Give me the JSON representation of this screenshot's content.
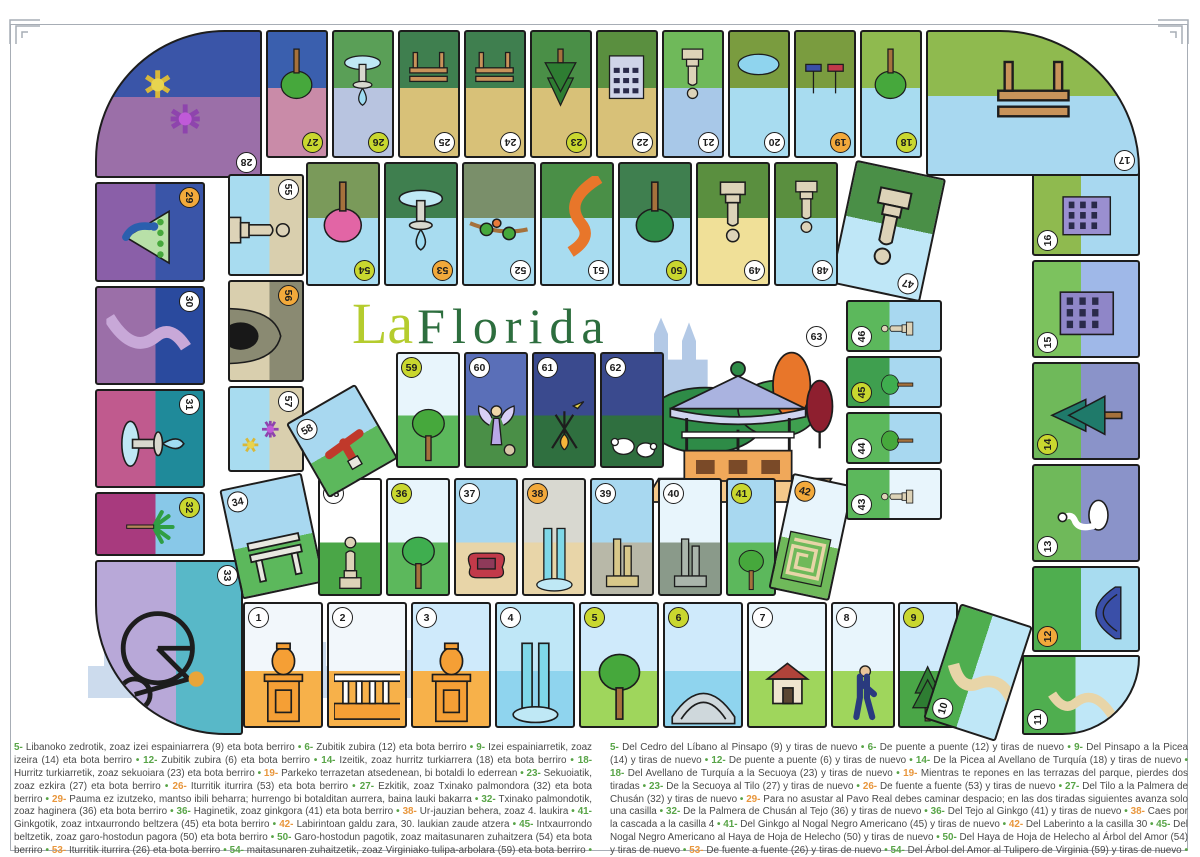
{
  "poster": {
    "title_la": "La",
    "title_florida": "Florida",
    "title_la_color": "#b5cc2e",
    "title_florida_color": "#2d6e3e"
  },
  "board": {
    "badge_colors": {
      "normal": "#ffffff",
      "jump": "#c9d72f",
      "event": "#f2a93b",
      "final": "#ffffff"
    },
    "final_badge": "63",
    "cells": [
      {
        "n": 1,
        "name": "pilar-entrada",
        "kind": "normal",
        "motif": "urn",
        "sky": "#f2f7fb",
        "ground": "#f7b14a"
      },
      {
        "n": 2,
        "name": "barandilla",
        "kind": "normal",
        "motif": "railing",
        "sky": "#f2f7fb",
        "ground": "#f7b14a"
      },
      {
        "n": 3,
        "name": "pilar",
        "kind": "normal",
        "motif": "urn",
        "sky": "#cfeafb",
        "ground": "#f7b14a"
      },
      {
        "n": 4,
        "name": "estanque-cascada",
        "kind": "normal",
        "motif": "waterfall",
        "sky": "#bfe7f7",
        "ground": "#8fd4ee"
      },
      {
        "n": 5,
        "name": "cedro-del-libano",
        "kind": "jump",
        "motif": "tree",
        "c": "#46a83c",
        "sky": "#cfeafb",
        "ground": "#9fd65c"
      },
      {
        "n": 6,
        "name": "puente",
        "kind": "jump",
        "motif": "bridge",
        "sky": "#cfeafb",
        "ground": "#8fd4ee"
      },
      {
        "n": 7,
        "name": "caseta",
        "kind": "normal",
        "motif": "hut",
        "sky": "#e8f5fc",
        "ground": "#9fd65c"
      },
      {
        "n": 8,
        "name": "paseante",
        "kind": "normal",
        "motif": "person",
        "sky": "#e8f5fc",
        "ground": "#9fd65c"
      },
      {
        "n": 9,
        "name": "pinsapo",
        "kind": "jump",
        "motif": "pine",
        "c": "#2e7d32",
        "sky": "#cfeafb",
        "ground": "#4aa647"
      },
      {
        "n": 10,
        "name": "senda-rio",
        "kind": "normal",
        "motif": "path",
        "sky": "#bfe7f7",
        "ground": "#4fae4f"
      },
      {
        "n": 11,
        "name": "senda-rio",
        "kind": "normal",
        "motif": "path",
        "sky": "#bfe7f7",
        "ground": "#4fae4f"
      },
      {
        "n": 12,
        "name": "puente-azul",
        "kind": "event",
        "motif": "bridge",
        "c": "#3a4fa8",
        "sky": "#a8dcf0",
        "ground": "#4fae4f"
      },
      {
        "n": 13,
        "name": "cisne",
        "kind": "normal",
        "motif": "swan",
        "sky": "#8a93c9",
        "ground": "#6fb95a"
      },
      {
        "n": 14,
        "name": "picea",
        "kind": "jump",
        "motif": "pine",
        "c": "#1f7a6a",
        "sky": "#8a93c9",
        "ground": "#6fb95a"
      },
      {
        "n": 15,
        "name": "edificio-flores",
        "kind": "normal",
        "motif": "building",
        "c": "#8f86c8",
        "sky": "#9fb8e8",
        "ground": "#7cc25e"
      },
      {
        "n": 16,
        "name": "edificio",
        "kind": "normal",
        "motif": "building",
        "c": "#9a8fd0",
        "sky": "#a8d8f0",
        "ground": "#8fba4f"
      },
      {
        "n": 17,
        "name": "merendero",
        "kind": "normal",
        "motif": "bench",
        "sky": "#a8d8f0",
        "ground": "#8fba4f"
      },
      {
        "n": 18,
        "name": "avellano-de-turquia",
        "kind": "jump",
        "motif": "tree",
        "c": "#46a83c",
        "sky": "#a8dcf0",
        "ground": "#8fba4f"
      },
      {
        "n": 19,
        "name": "terrazas-embarcadero",
        "kind": "event",
        "motif": "boats",
        "sky": "#a8dcf0",
        "ground": "#7a9c3f"
      },
      {
        "n": 20,
        "name": "estanque",
        "kind": "normal",
        "motif": "pond",
        "sky": "#a8dcf0",
        "ground": "#7a9c3f"
      },
      {
        "n": 21,
        "name": "estatua",
        "kind": "normal",
        "motif": "statue",
        "sky": "#a8c8e8",
        "ground": "#6fb95a"
      },
      {
        "n": 22,
        "name": "palacete",
        "kind": "normal",
        "motif": "building",
        "c": "#cfd4e8",
        "sky": "#d8c178",
        "ground": "#5a8f3f"
      },
      {
        "n": 23,
        "name": "secuoya",
        "kind": "jump",
        "motif": "pine",
        "c": "#2e7d32",
        "sky": "#d8c178",
        "ground": "#4a8f47"
      },
      {
        "n": 24,
        "name": "banco",
        "kind": "normal",
        "motif": "bench",
        "sky": "#d8c178",
        "ground": "#3f7f4f"
      },
      {
        "n": 25,
        "name": "banco",
        "kind": "normal",
        "motif": "bench",
        "sky": "#d8c178",
        "ground": "#3f7f4f"
      },
      {
        "n": 26,
        "name": "fuente",
        "kind": "jump",
        "motif": "fountain",
        "sky": "#b8c4e0",
        "ground": "#5a9f57"
      },
      {
        "n": 27,
        "name": "tilo",
        "kind": "jump",
        "motif": "tree",
        "c": "#46a83c",
        "sky": "#c98ba8",
        "ground": "#3a5fae"
      },
      {
        "n": 28,
        "name": "parterres",
        "kind": "normal",
        "motif": "flowers",
        "sky": "#9b6fa8",
        "ground": "#3a55a8"
      },
      {
        "n": 29,
        "name": "pavo-real",
        "kind": "event",
        "motif": "peacock",
        "sky": "#8a5fa8",
        "ground": "#3a55a8"
      },
      {
        "n": 30,
        "name": "paseo-nocturno",
        "kind": "normal",
        "motif": "path",
        "c": "#c8a8d8",
        "sky": "#9b6fa8",
        "ground": "#2a4a9e"
      },
      {
        "n": 31,
        "name": "fuente-nocturna",
        "kind": "normal",
        "motif": "fountain",
        "sky": "#c05a8e",
        "ground": "#1f8a9a"
      },
      {
        "n": 32,
        "name": "palmera-de-chusan",
        "kind": "jump",
        "motif": "palm",
        "sky": "#a83a7e",
        "ground": "#88c8e8"
      },
      {
        "n": 33,
        "name": "biciclo",
        "kind": "normal",
        "motif": "bicycle",
        "sky": "#b8a8d8",
        "ground": "#58b8c8"
      },
      {
        "n": 34,
        "name": "pergola",
        "kind": "normal",
        "motif": "bench",
        "c": "#e8e8e0",
        "sky": "#a8d8f0",
        "ground": "#5cb85c"
      },
      {
        "n": 35,
        "name": "estatua",
        "kind": "normal",
        "motif": "statue",
        "sky": "#ffffff",
        "ground": "#4aa647"
      },
      {
        "n": 36,
        "name": "tejo",
        "kind": "jump",
        "motif": "tree",
        "c": "#3fae4f",
        "sky": "#e8f5fc",
        "ground": "#5cb85c"
      },
      {
        "n": 37,
        "name": "sofa-escultura",
        "kind": "normal",
        "motif": "sofa",
        "sky": "#a8d8f0",
        "ground": "#e8d5a8"
      },
      {
        "n": 38,
        "name": "cascada",
        "kind": "event",
        "motif": "waterfall",
        "sky": "#d8d8d0",
        "ground": "#e8d5a8"
      },
      {
        "n": 39,
        "name": "escultura",
        "kind": "normal",
        "motif": "monument",
        "c": "#d8c88a",
        "sky": "#a8d8f0",
        "ground": "#b8b8a8"
      },
      {
        "n": 40,
        "name": "monumento",
        "kind": "normal",
        "motif": "monument",
        "c": "#aab5ab",
        "sky": "#e8f5fc",
        "ground": "#8a9a8a"
      },
      {
        "n": 41,
        "name": "ginkgo",
        "kind": "jump",
        "motif": "tree",
        "c": "#46a83c",
        "sky": "#a8d8f0",
        "ground": "#5cb85c"
      },
      {
        "n": 42,
        "name": "laberinto",
        "kind": "event",
        "motif": "maze",
        "sky": "#e8f5fc",
        "ground": "#6fb95a"
      },
      {
        "n": 43,
        "name": "estatua",
        "kind": "normal",
        "motif": "statue",
        "sky": "#e8f5fc",
        "ground": "#5cb85c"
      },
      {
        "n": 44,
        "name": "arboles-senda",
        "kind": "normal",
        "motif": "tree",
        "c": "#46a83c",
        "sky": "#a8d8f0",
        "ground": "#5cb85c"
      },
      {
        "n": 45,
        "name": "nogal-negro-americano",
        "kind": "jump",
        "motif": "tree",
        "c": "#3fae4f",
        "sky": "#a8d8f0",
        "ground": "#3f9f4f"
      },
      {
        "n": 46,
        "name": "estatua",
        "kind": "normal",
        "motif": "statue",
        "sky": "#a8d8f0",
        "ground": "#5cb85c"
      },
      {
        "n": 47,
        "name": "estatua",
        "kind": "normal",
        "motif": "statue",
        "sky": "#bfe7f7",
        "ground": "#4a8f47"
      },
      {
        "n": 48,
        "name": "estatua",
        "kind": "normal",
        "motif": "statue",
        "sky": "#a8dcf0",
        "ground": "#5a8f3f"
      },
      {
        "n": 49,
        "name": "estatua",
        "kind": "normal",
        "motif": "statue",
        "sky": "#f0e098",
        "ground": "#5a8f3f"
      },
      {
        "n": 50,
        "name": "haya-de-hoja-de-helecho",
        "kind": "jump",
        "motif": "tree",
        "c": "#2e8b47",
        "sky": "#a8dcf0",
        "ground": "#3f7f4f"
      },
      {
        "n": 51,
        "name": "senda-naranja",
        "kind": "normal",
        "motif": "path",
        "c": "#e8762a",
        "sky": "#a8dcf0",
        "ground": "#4a8f47"
      },
      {
        "n": 52,
        "name": "rama-estanque",
        "kind": "normal",
        "motif": "branch",
        "sky": "#a8dcf0",
        "ground": "#7a8f6a"
      },
      {
        "n": 53,
        "name": "fuente",
        "kind": "event",
        "motif": "fountain",
        "sky": "#a8dcf0",
        "ground": "#3f7f4f"
      },
      {
        "n": 54,
        "name": "arbol-del-amor",
        "kind": "jump",
        "motif": "pinktree",
        "sky": "#a8dcf0",
        "ground": "#7a9a5a"
      },
      {
        "n": 55,
        "name": "estatua-rocas",
        "kind": "normal",
        "motif": "statue",
        "sky": "#a8dcf0",
        "ground": "#d9cfae"
      },
      {
        "n": 56,
        "name": "gruta",
        "kind": "event",
        "motif": "cave",
        "sky": "#d9cfae",
        "ground": "#8a8a72"
      },
      {
        "n": 57,
        "name": "flores",
        "kind": "normal",
        "motif": "flowers",
        "sky": "#a8dcf0",
        "ground": "#d9cfae"
      },
      {
        "n": 58,
        "name": "escultura-roja",
        "kind": "normal",
        "motif": "redart",
        "sky": "#a8d8f0",
        "ground": "#5cb85c"
      },
      {
        "n": 59,
        "name": "tulipero-de-virginia",
        "kind": "jump",
        "motif": "tree",
        "c": "#46a83c",
        "sky": "#e8f5fc",
        "ground": "#5cb85c"
      },
      {
        "n": 60,
        "name": "angel",
        "kind": "normal",
        "motif": "angel",
        "sky": "#5a6fb8",
        "ground": "#4a8f47"
      },
      {
        "n": 61,
        "name": "hoguera",
        "kind": "normal",
        "motif": "campfire",
        "sky": "#3a4a8e",
        "ground": "#2f6f3f"
      },
      {
        "n": 62,
        "name": "ovejas",
        "kind": "normal",
        "motif": "sheep",
        "sky": "#3a4a8e",
        "ground": "#2f6f3f"
      },
      {
        "n": 63,
        "name": "kiosco",
        "kind": "final",
        "motif": "kiosk",
        "sky": "#ffffff",
        "ground": "#f5c98a"
      }
    ]
  },
  "rules": {
    "special_nums": [
      19,
      26,
      29,
      38,
      42,
      53,
      56
    ],
    "num_color": "#58a447",
    "num_color_special": "#e8963c",
    "basque": [
      {
        "n": "5",
        "t": "Libanoko zedrotik, zoaz izei espainiarrera (9) eta bota berriro"
      },
      {
        "n": "6",
        "t": "Zubitik zubira (12) eta bota berriro"
      },
      {
        "n": "9",
        "t": "Izei espainiarretik, zoaz izeira (14) eta bota berriro"
      },
      {
        "n": "12",
        "t": "Zubitik zubira (6) eta bota berriro"
      },
      {
        "n": "14",
        "t": "Izeitik, zoaz hurritz turkiarrera (18) eta bota berriro"
      },
      {
        "n": "18",
        "t": "Hurritz turkiarretik, zoaz sekuoiara (23) eta bota berriro"
      },
      {
        "n": "19",
        "t": "Parkeko terrazetan atsedenean, bi botaldi lo ederrean"
      },
      {
        "n": "23",
        "t": "Sekuoiatik, zoaz ezkira (27) eta bota berriro"
      },
      {
        "n": "26",
        "t": "Iturritik iturrira (53) eta bota berriro"
      },
      {
        "n": "27",
        "t": "Ezkitik, zoaz Txinako palmondora (32) eta bota berriro"
      },
      {
        "n": "29",
        "t": "Pauma ez izutzeko, mantso ibili beharra; hurrengo bi botalditan aurrera, baina lauki bakarra"
      },
      {
        "n": "32",
        "t": "Txinako palmondotik, zoaz haginera (36) eta bota berriro"
      },
      {
        "n": "36",
        "t": "Haginetik, zoaz ginkgora (41) eta bota berriro"
      },
      {
        "n": "38",
        "t": "Ur-jauzian behera, zoaz 4. laukira"
      },
      {
        "n": "41",
        "t": "Ginkgotik, zoaz intxaurrondo beltzera (45) eta bota berriro"
      },
      {
        "n": "42",
        "t": "Labirintoan galdu zara, 30. laukian zaude atzera"
      },
      {
        "n": "45",
        "t": "Intxaurrondo beltzetik, zoaz garo-hostodun pagora (50) eta bota berriro"
      },
      {
        "n": "50",
        "t": "Garo-hostodun pagotik, zoaz maitasunaren zuhaitzera (54) eta bota berriro"
      },
      {
        "n": "53",
        "t": "Iturritik iturrira (26) eta bota berriro"
      },
      {
        "n": "54",
        "t": "maitasunaren zuhaitzetik, zoaz Virginiako tulipa-arbolara (59) eta bota berriro"
      },
      {
        "n": "56",
        "t": "Sartu zara leizean, eta agertu irteera-laukian"
      },
      {
        "n": "59",
        "t": "Virginiako tulipa-arbolatik Kioskora (63)"
      }
    ],
    "basque_win": "Zorionak, partida irabazi duzu!",
    "spanish": [
      {
        "n": "5",
        "t": "Del Cedro del Líbano al Pinsapo (9) y tiras de nuevo"
      },
      {
        "n": "6",
        "t": "De puente a puente (12) y tiras de nuevo"
      },
      {
        "n": "9",
        "t": "Del Pinsapo a la Picea (14) y tiras de nuevo"
      },
      {
        "n": "12",
        "t": "De puente a puente (6) y tiras de nuevo"
      },
      {
        "n": "14",
        "t": "De la Picea al Avellano de Turquía (18) y tiras de nuevo"
      },
      {
        "n": "18",
        "t": "Del Avellano de Turquía a la Secuoya (23) y tiras de nuevo"
      },
      {
        "n": "19",
        "t": "Mientras te repones en las terrazas del parque, pierdes dos tiradas"
      },
      {
        "n": "23",
        "t": "De la Secuoya al Tilo (27) y tiras de nuevo"
      },
      {
        "n": "26",
        "t": "De fuente a fuente (53) y tiras de nuevo"
      },
      {
        "n": "27",
        "t": "Del Tilo a la Palmera de Chusán (32) y tiras de nuevo"
      },
      {
        "n": "29",
        "t": "Para no asustar al Pavo Real debes caminar despacio; en las dos tiradas siguientes avanza solo una casilla"
      },
      {
        "n": "32",
        "t": "De la Palmera de Chusán al Tejo (36) y tiras de nuevo"
      },
      {
        "n": "36",
        "t": "Del Tejo al Ginkgo (41) y tiras de nuevo"
      },
      {
        "n": "38",
        "t": "Caes por la cascada a la casilla 4"
      },
      {
        "n": "41",
        "t": "Del Ginkgo al Nogal Negro Americano (45) y tiras de nuevo"
      },
      {
        "n": "42",
        "t": "Del Laberinto a la casilla 30"
      },
      {
        "n": "45",
        "t": "Del Nogal Negro Americano al Haya de Hoja de Helecho (50) y tiras de nuevo"
      },
      {
        "n": "50",
        "t": "Del Haya de Hoja de Helecho al Árbol del Amor (54) y tiras de nuevo"
      },
      {
        "n": "53",
        "t": "De fuente a fuente (26) y tiras de nuevo"
      },
      {
        "n": "54",
        "t": "Del Árbol del Amor al Tulipero de Virginia (59) y tiras de nuevo"
      },
      {
        "n": "56",
        "t": "Entras en la Gruta y apareces en la casilla de salida"
      },
      {
        "n": "59",
        "t": "Del Tulipero de Virginia al Kiosco (63)"
      }
    ],
    "spanish_win": "¡Has ganado la partida!"
  }
}
